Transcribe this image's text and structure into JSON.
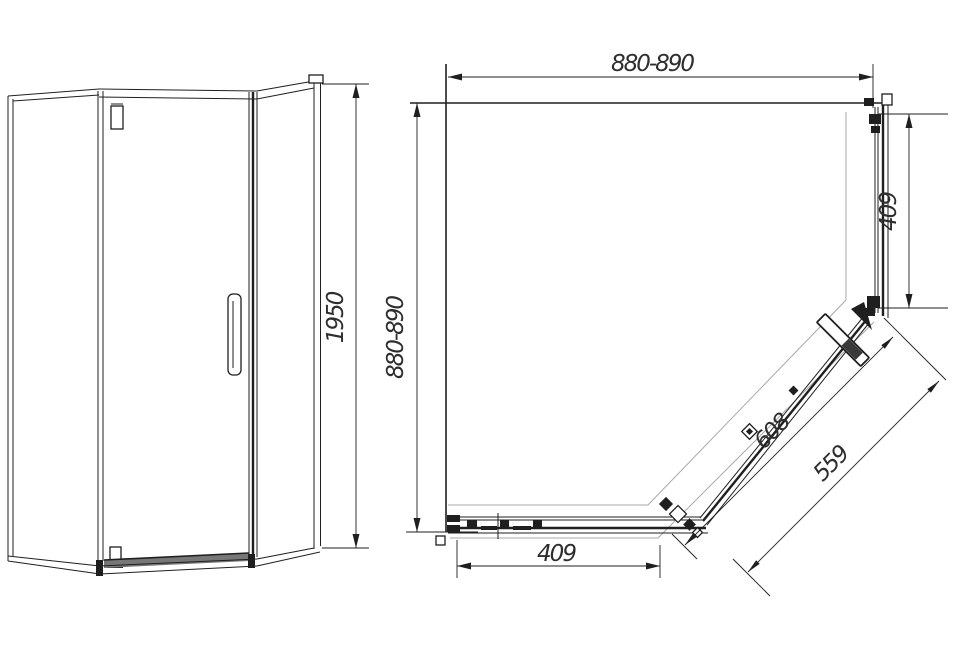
{
  "colors": {
    "line": "#1f1f1f",
    "gray": "#a9a9a9",
    "text": "#2e2e2e",
    "bg": "#ffffff"
  },
  "front_view": {
    "height_dim": "1950"
  },
  "plan_view": {
    "width_dim": "880-890",
    "depth_dim": "880-890",
    "side_panel_dim": "409",
    "front_panel_dim": "409",
    "diagonal_dim": "608",
    "door_dim": "559"
  }
}
